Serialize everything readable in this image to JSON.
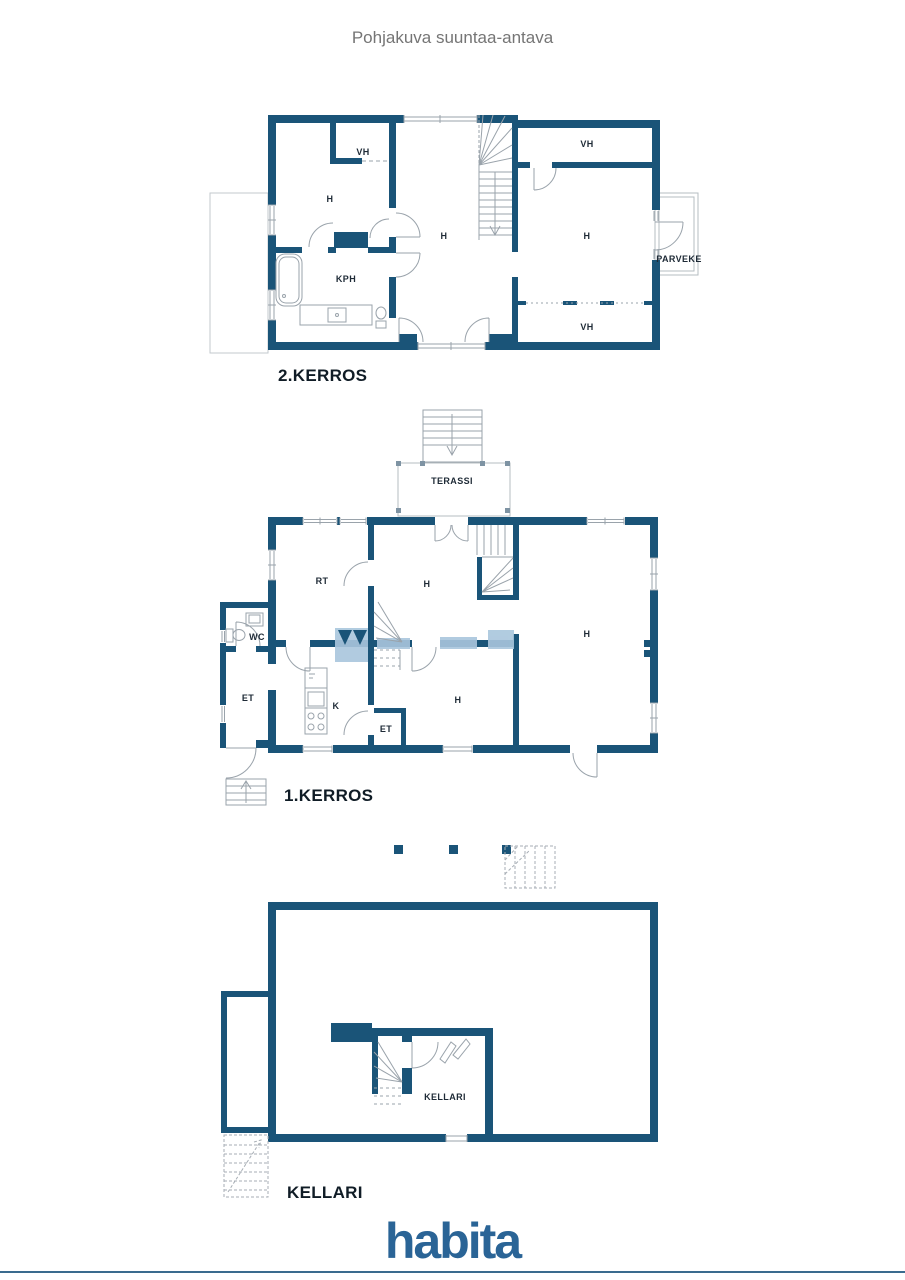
{
  "title": "Pohjakuva suuntaa-antava",
  "floors": {
    "floor2": {
      "label": "2.KERROS",
      "rooms": {
        "vh_top_left": "VH",
        "h_left": "H",
        "kph": "KPH",
        "h_hall": "H",
        "vh_top_right": "VH",
        "h_right": "H",
        "vh_bottom_right": "VH",
        "parveke": "PARVEKE"
      }
    },
    "floor1": {
      "label": "1.KERROS",
      "rooms": {
        "terassi": "TERASSI",
        "rt": "RT",
        "h_center": "H",
        "h_right": "H",
        "wc": "WC",
        "et_left": "ET",
        "kitchen": "K",
        "et_small": "ET",
        "h_bottom": "H"
      }
    },
    "basement": {
      "label": "KELLARI",
      "rooms": {
        "kellari": "KELLARI"
      }
    }
  },
  "footer": {
    "logo": "habita"
  },
  "colors": {
    "wall": "#1a5478",
    "watermark": "#a9c6dd",
    "logo": "#2a6496",
    "baseline": "#3a6b8e",
    "title_gray": "#757575"
  }
}
